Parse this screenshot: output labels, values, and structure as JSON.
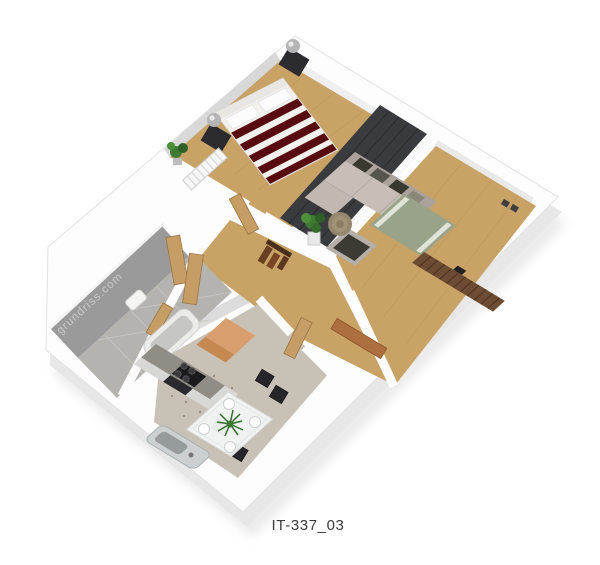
{
  "artwork": {
    "type": "3d-isometric-floorplan-render",
    "watermark": "grundriss.com",
    "plan_label": "IT-337_03"
  },
  "palette": {
    "background": "#ffffff",
    "wood_floor": "#c9a265",
    "wall_white": "#fdfdfd",
    "wall_shade": "#d8d8d8",
    "wall_shadow_gray": "#9a9a9a",
    "plinth_side": "#ececec",
    "bedding_red": "#570b0e",
    "bedding_white": "#f3f1ee",
    "wardrobe_dark": "#3a3b3e",
    "sofa_taupe": "#c6beb7",
    "rug_green": "#98a38a",
    "sideboard_brown": "#6e4c34",
    "door_wood": "#c79d66",
    "accent_orange": "#d99e6d",
    "bath_tile": "#b5b3af",
    "kitchen_floor": "#c8c1b6",
    "kitchen_counter": "#8f8d85",
    "appliance_black": "#1b1b1e",
    "plant_green": "#3f7a33",
    "label_color": "#3a3a3a",
    "watermark_color": "#c8c8c8"
  },
  "scene": {
    "rooms": [
      {
        "name": "bedroom",
        "floor": "wood",
        "furniture": [
          "double-bed",
          "headboard",
          "pillows",
          "striped-duvet",
          "nightstand-left",
          "nightstand-right",
          "ball-lamp-left",
          "ball-lamp-right",
          "wardrobe",
          "radiator",
          "potted-plant"
        ]
      },
      {
        "name": "living-room",
        "floor": "wood",
        "furniture": [
          "corner-sofa",
          "throw-pillows",
          "area-rug",
          "armchair",
          "wicker-ottoman",
          "slatted-sideboard",
          "window-sill",
          "sill-objects"
        ]
      },
      {
        "name": "hallway",
        "floor": "wood",
        "furniture": [
          "potted-plant",
          "coat-rack",
          "interior-doors",
          "entrance-door-panel"
        ]
      },
      {
        "name": "bathroom",
        "floor": "stone-tile",
        "furniture": [
          "bathtub",
          "washbasin"
        ]
      },
      {
        "name": "kitchen-dining",
        "floor": "tile",
        "furniture": [
          "kitchen-counter",
          "stove",
          "oven",
          "refrigerator-cabinet",
          "sink",
          "dining-table",
          "dining-chairs",
          "table-plant",
          "place-settings"
        ]
      }
    ]
  }
}
